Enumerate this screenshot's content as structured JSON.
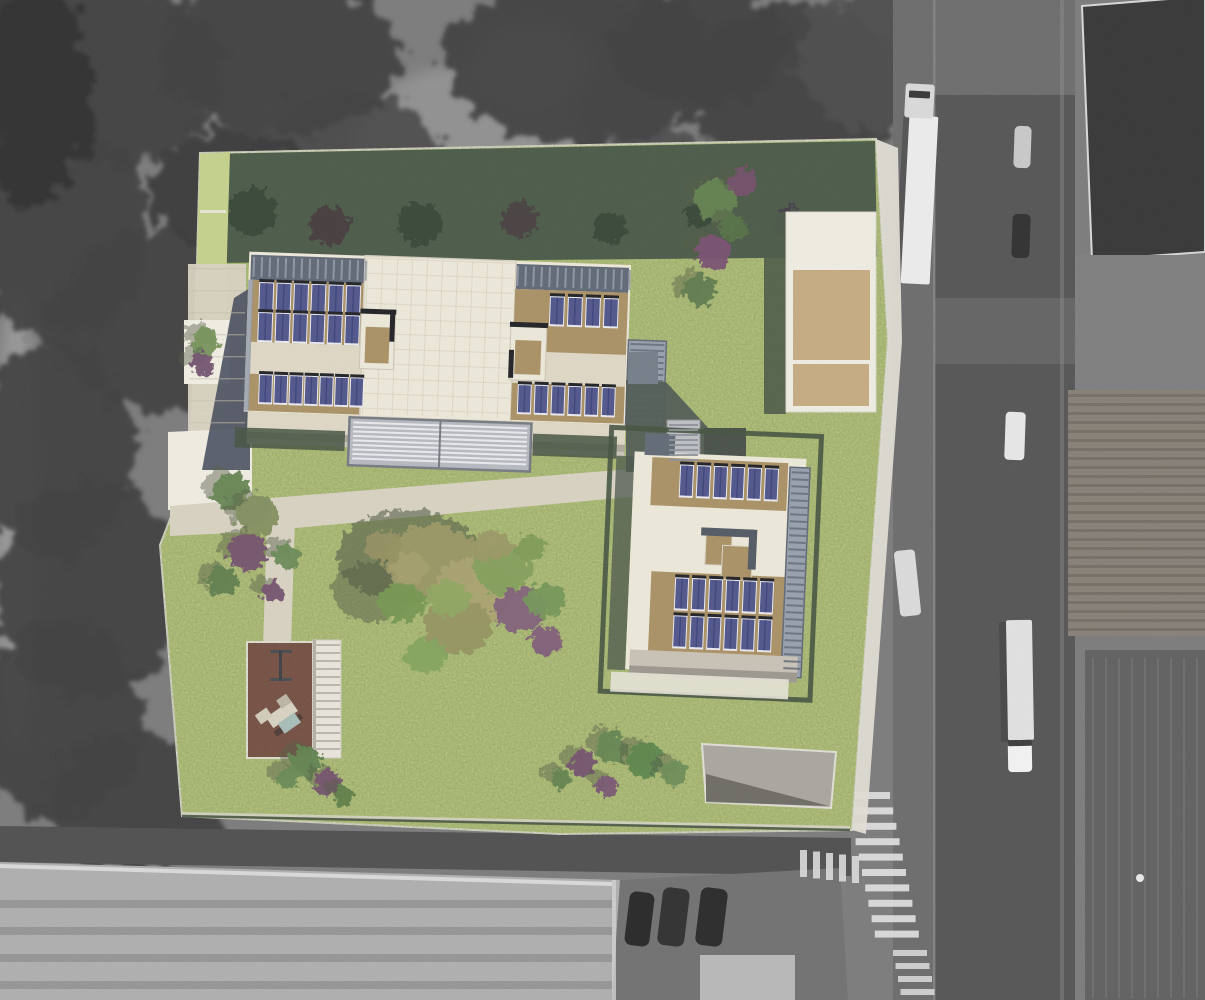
{
  "scene": {
    "kind": "aerial-photo-with-architectural-site-plan-overlay",
    "photo_style": "grayscale-orthophoto",
    "overlay_style": "colored-rendered-site-plan"
  },
  "palette": {
    "photoBg": "#757575",
    "forest": "#353535",
    "forestDark": "#282828",
    "road": "#4c4c4c",
    "sidewalk": "#646464",
    "roofLight": "#ababab",
    "buildDark": "#2d2d2d",
    "tileRoof": "#81796e",
    "warehouse": "#585858",
    "lawn": "#b8c878",
    "lawnLight": "#c2cf86",
    "lawnShadow": "#42523f",
    "cream": "#ece7d8",
    "cream2": "#ddd6c3",
    "tan": "#a78c5e",
    "tanLight": "#c3a87c",
    "panel": "#484d86",
    "panelDark": "#15161b",
    "panelEdge": "#e9e9f0",
    "skylight": "#59616f",
    "balcony": "#929ba8",
    "path": "#d7d0bf",
    "plaza": "#efece1",
    "maroon": "#6f4038",
    "hedge": "#3c4a37",
    "shadowBlue": "#3a4152",
    "courtyard": "#49534c",
    "pergola": "#b3b7bd"
  },
  "photo": {
    "forest": [
      {
        "x": 95,
        "y": 75,
        "rx": 130,
        "ry": 95
      },
      {
        "x": 280,
        "y": 55,
        "rx": 120,
        "ry": 80
      },
      {
        "x": 585,
        "y": 60,
        "rx": 140,
        "ry": 85
      },
      {
        "x": 800,
        "y": 90,
        "rx": 110,
        "ry": 85
      },
      {
        "x": 60,
        "y": 230,
        "rx": 90,
        "ry": 110
      },
      {
        "x": 160,
        "y": 320,
        "rx": 110,
        "ry": 90
      },
      {
        "x": 55,
        "y": 450,
        "rx": 80,
        "ry": 110
      },
      {
        "x": 90,
        "y": 590,
        "rx": 95,
        "ry": 110
      },
      {
        "x": 60,
        "y": 720,
        "rx": 85,
        "ry": 100
      },
      {
        "x": 135,
        "y": 800,
        "rx": 90,
        "ry": 70
      },
      {
        "x": 350,
        "y": 160,
        "rx": 90,
        "ry": 70,
        "o": 0.8
      },
      {
        "x": 700,
        "y": 45,
        "rx": 90,
        "ry": 60
      },
      {
        "x": 870,
        "y": 60,
        "rx": 70,
        "ry": 70,
        "c": "#424242"
      },
      {
        "x": 540,
        "y": 230,
        "rx": 80,
        "ry": 55,
        "o": 0.75
      },
      {
        "x": 660,
        "y": 180,
        "rx": 70,
        "ry": 50,
        "o": 0.7
      },
      {
        "x": 30,
        "y": 90,
        "rx": 60,
        "ry": 120,
        "c": "#262626"
      },
      {
        "x": 230,
        "y": 190,
        "rx": 80,
        "ry": 60,
        "c": "#2e2e2e"
      },
      {
        "x": 460,
        "y": 320,
        "rx": 60,
        "ry": 40,
        "o": 0.6
      }
    ],
    "clearings": [
      {
        "x": 470,
        "y": 150,
        "rx": 115,
        "ry": 85,
        "c": "#8e8e8e",
        "o": 0.9
      },
      {
        "x": 530,
        "y": 65,
        "rx": 60,
        "ry": 45,
        "c": "#9c9c9c",
        "o": 0.8
      },
      {
        "x": 250,
        "y": 330,
        "rx": 45,
        "ry": 35,
        "c": "#7e7e7e",
        "o": 0.6
      },
      {
        "x": 640,
        "y": 330,
        "rx": 55,
        "ry": 40,
        "c": "#757575",
        "o": 0.55
      },
      {
        "x": 16,
        "y": 520,
        "rx": 20,
        "ry": 230,
        "c": "#9a9a9a",
        "o": 0.8
      }
    ],
    "vehicles": [
      {
        "name": "semi-truck-shadow",
        "x": 899,
        "y": 116,
        "w": 8,
        "h": 168,
        "rx": 2,
        "c": "#2f2f2f",
        "o": 0.5,
        "rot": 3
      },
      {
        "name": "semi-truck-trailer",
        "x": 905,
        "y": 116,
        "w": 29,
        "h": 168,
        "rx": 2,
        "c": "#ececec",
        "rot": 3
      },
      {
        "name": "semi-truck-cab",
        "x": 905,
        "y": 84,
        "w": 29,
        "h": 34,
        "rx": 3,
        "c": "#d8d8d8",
        "rot": 3
      },
      {
        "name": "semi-truck-windshield",
        "x": 909,
        "y": 91,
        "w": 21,
        "h": 7,
        "rx": 1,
        "c": "#2c2c2c",
        "rot": 3
      },
      {
        "name": "car-light",
        "x": 1014,
        "y": 126,
        "w": 17,
        "h": 42,
        "rx": 5,
        "c": "#c6c6c6",
        "rot": 2
      },
      {
        "name": "car-dark",
        "x": 1012,
        "y": 214,
        "w": 18,
        "h": 44,
        "rx": 5,
        "c": "#262626",
        "rot": 2
      },
      {
        "name": "van-white",
        "x": 1005,
        "y": 412,
        "w": 20,
        "h": 48,
        "rx": 4,
        "c": "#e6e6e6",
        "rot": 2
      },
      {
        "name": "parked-truck-white",
        "x": 897,
        "y": 550,
        "w": 21,
        "h": 66,
        "rx": 4,
        "c": "#d9d9d9",
        "rot": -6
      },
      {
        "name": "box-truck-shadow",
        "x": 1000,
        "y": 622,
        "w": 8,
        "h": 120,
        "rx": 2,
        "c": "#2f2f2f",
        "o": 0.5,
        "rot": -1
      },
      {
        "name": "box-truck-body",
        "x": 1007,
        "y": 620,
        "w": 26,
        "h": 120,
        "rx": 2,
        "c": "#e0e0e0",
        "rot": -1
      },
      {
        "name": "box-truck-cab",
        "x": 1008,
        "y": 742,
        "w": 24,
        "h": 30,
        "rx": 4,
        "c": "#f2f2f2",
        "rot": -1
      },
      {
        "name": "box-truck-windshield",
        "x": 1008,
        "y": 740,
        "w": 24,
        "h": 6,
        "rx": 1,
        "c": "#333333",
        "rot": -1
      },
      {
        "name": "parked-car-1",
        "x": 627,
        "y": 892,
        "w": 25,
        "h": 54,
        "rx": 7,
        "c": "#1d1d1d",
        "rot": 7
      },
      {
        "name": "parked-car-2",
        "x": 660,
        "y": 888,
        "w": 27,
        "h": 58,
        "rx": 7,
        "c": "#262626",
        "rot": 7
      },
      {
        "name": "parked-car-3",
        "x": 698,
        "y": 888,
        "w": 27,
        "h": 58,
        "rx": 7,
        "c": "#1f1f1f",
        "rot": 7
      },
      {
        "name": "forest-car-white",
        "x": 202,
        "y": 428,
        "w": 12,
        "h": 9,
        "rx": 2,
        "c": "#e2e2e2",
        "o": 0.9,
        "rot": -20
      }
    ],
    "crosswalks": [
      {
        "name": "crosswalk-main",
        "x": 846,
        "y": 792,
        "w": 44,
        "h": 7,
        "count": 10,
        "dx": 3.2,
        "dy": 15.4,
        "c": "#dcdcdc",
        "o": 0.95
      },
      {
        "name": "crosswalk-south",
        "x": 893,
        "y": 950,
        "w": 34,
        "h": 6,
        "count": 4,
        "dx": 2.5,
        "dy": 13,
        "c": "#d6d6d6",
        "o": 0.9
      },
      {
        "name": "crosswalk-west",
        "x": 800,
        "y": 850,
        "w": 7,
        "h": 27,
        "count": 5,
        "dx": 13,
        "dy": 1.5,
        "c": "#dadada",
        "o": 0.9
      }
    ]
  },
  "plan": {
    "boundary": "200,153 876,139 888,340 852,830 560,834 182,816 160,545 190,468 196,300",
    "solar_rows": [
      {
        "building": "b1",
        "x": 258,
        "y": 289,
        "n": 6,
        "dx": 17.4,
        "w": 13,
        "h": 27
      },
      {
        "building": "b1",
        "x": 258,
        "y": 319,
        "n": 6,
        "dx": 17.4,
        "w": 13,
        "h": 27
      },
      {
        "building": "b1",
        "x": 261,
        "y": 381,
        "n": 7,
        "dx": 15.2,
        "w": 12,
        "h": 27
      },
      {
        "building": "b1",
        "x": 549,
        "y": 293,
        "n": 4,
        "dx": 18,
        "w": 13,
        "h": 27
      },
      {
        "building": "b1",
        "x": 520,
        "y": 382,
        "n": 6,
        "dx": 16.8,
        "w": 12,
        "h": 27
      },
      {
        "building": "b2",
        "x": 677,
        "y": 467,
        "n": 6,
        "dx": 17,
        "w": 12,
        "h": 30
      },
      {
        "building": "b2",
        "x": 677,
        "y": 580,
        "n": 6,
        "dx": 17,
        "w": 12,
        "h": 30
      },
      {
        "building": "b2",
        "x": 677,
        "y": 618,
        "n": 6,
        "dx": 17,
        "w": 12,
        "h": 30
      }
    ],
    "trees": [
      {
        "x": 206,
        "y": 341,
        "r": 14,
        "c": "#6f8d50"
      },
      {
        "x": 202,
        "y": 364,
        "r": 12,
        "c": "#6b4a68"
      },
      {
        "x": 716,
        "y": 200,
        "r": 21,
        "c": "#5d7c48"
      },
      {
        "x": 742,
        "y": 183,
        "r": 14,
        "c": "#6d4662"
      },
      {
        "x": 713,
        "y": 252,
        "r": 17,
        "c": "#74486a"
      },
      {
        "x": 699,
        "y": 291,
        "r": 16,
        "c": "#587546"
      },
      {
        "x": 734,
        "y": 228,
        "r": 13,
        "c": "#4e6a3e"
      },
      {
        "x": 231,
        "y": 492,
        "r": 19,
        "c": "#5f7f4a"
      },
      {
        "x": 257,
        "y": 516,
        "r": 21,
        "c": "#7c8a56"
      },
      {
        "x": 247,
        "y": 552,
        "r": 19,
        "c": "#6e4a66"
      },
      {
        "x": 222,
        "y": 582,
        "r": 15,
        "c": "#5a7a46"
      },
      {
        "x": 287,
        "y": 556,
        "r": 13,
        "c": "#64854e"
      },
      {
        "x": 272,
        "y": 592,
        "r": 11,
        "c": "#6d4a66"
      },
      {
        "x": 305,
        "y": 762,
        "r": 16,
        "c": "#5b7d48"
      },
      {
        "x": 328,
        "y": 783,
        "r": 13,
        "c": "#6e4a66"
      },
      {
        "x": 288,
        "y": 778,
        "r": 11,
        "c": "#61834c"
      },
      {
        "x": 344,
        "y": 796,
        "r": 10,
        "c": "#57793f"
      },
      {
        "x": 583,
        "y": 764,
        "r": 13,
        "c": "#6d4a66"
      },
      {
        "x": 612,
        "y": 748,
        "r": 16,
        "c": "#5e8048"
      },
      {
        "x": 645,
        "y": 760,
        "r": 18,
        "c": "#548044"
      },
      {
        "x": 674,
        "y": 772,
        "r": 13,
        "c": "#67884f"
      },
      {
        "x": 607,
        "y": 786,
        "r": 11,
        "c": "#744f6c"
      },
      {
        "x": 561,
        "y": 779,
        "r": 10,
        "c": "#5c7d46"
      }
    ],
    "band_trees": [
      {
        "x": 252,
        "y": 212,
        "r": 24,
        "c": "#2c3b2c"
      },
      {
        "x": 330,
        "y": 226,
        "r": 20,
        "c": "#3c3033"
      },
      {
        "x": 420,
        "y": 224,
        "r": 22,
        "c": "#2c3b2c"
      },
      {
        "x": 520,
        "y": 220,
        "r": 18,
        "c": "#403236"
      },
      {
        "x": 610,
        "y": 228,
        "r": 16,
        "c": "#2c3b2c"
      },
      {
        "x": 790,
        "y": 224,
        "r": 17,
        "c": "#383440"
      },
      {
        "x": 700,
        "y": 214,
        "r": 14,
        "c": "#2c3b2c"
      }
    ],
    "garden": [
      {
        "x": 408,
        "y": 556,
        "rx": 72,
        "ry": 46,
        "c": "#4a523c",
        "o": 0.6
      },
      {
        "x": 372,
        "y": 592,
        "rx": 40,
        "ry": 30,
        "c": "#4a523c",
        "o": 0.5
      },
      {
        "x": 432,
        "y": 562,
        "rx": 46,
        "ry": 38,
        "c": "#97945f"
      },
      {
        "x": 472,
        "y": 592,
        "rx": 40,
        "ry": 34,
        "c": "#a59e68"
      },
      {
        "x": 502,
        "y": 570,
        "rx": 28,
        "ry": 24,
        "c": "#7d9a52"
      },
      {
        "x": 457,
        "y": 626,
        "rx": 34,
        "ry": 28,
        "c": "#8f8e58"
      },
      {
        "x": 520,
        "y": 610,
        "rx": 26,
        "ry": 22,
        "c": "#7b5874"
      },
      {
        "x": 546,
        "y": 600,
        "rx": 20,
        "ry": 17,
        "c": "#6f9150"
      },
      {
        "x": 402,
        "y": 602,
        "rx": 24,
        "ry": 20,
        "c": "#709148"
      },
      {
        "x": 426,
        "y": 656,
        "rx": 21,
        "ry": 17,
        "c": "#7da054"
      },
      {
        "x": 384,
        "y": 546,
        "rx": 19,
        "ry": 16,
        "c": "#8f8c58"
      },
      {
        "x": 546,
        "y": 641,
        "rx": 16,
        "ry": 14,
        "c": "#7a5572"
      },
      {
        "x": 492,
        "y": 546,
        "rx": 21,
        "ry": 16,
        "c": "#96945e"
      },
      {
        "x": 530,
        "y": 548,
        "rx": 16,
        "ry": 13,
        "c": "#77964e"
      },
      {
        "x": 410,
        "y": 568,
        "rx": 18,
        "ry": 15,
        "c": "#a09a64"
      },
      {
        "x": 448,
        "y": 598,
        "rx": 22,
        "ry": 18,
        "c": "#8aa258"
      }
    ]
  },
  "stripes": [
    {
      "name": "skylight-ticks-left",
      "target": "b1-extras",
      "x": 250,
      "y": 263,
      "w": 112,
      "h": 20,
      "dir": "v",
      "gap": 8,
      "sw": 2,
      "c": "#8d96a4",
      "o": 0.9
    },
    {
      "name": "skylight-ticks-right",
      "target": "b1-extras",
      "x": 514,
      "y": 263,
      "w": 112,
      "h": 20,
      "dir": "v",
      "gap": 8,
      "sw": 2,
      "c": "#8d96a4",
      "o": 0.9
    },
    {
      "name": "balcony-stripes",
      "target": "b1-extras",
      "x": 630,
      "y": 336,
      "w": 34,
      "h": 78,
      "dir": "h",
      "gap": 6,
      "sw": 2,
      "c": "#5f6774",
      "o": 0.9
    },
    {
      "name": "pergola-slats",
      "target": "b1-extras",
      "x": 356,
      "y": 424,
      "w": 174,
      "h": 38,
      "dir": "h",
      "gap": 4.5,
      "sw": 2,
      "c": "#eef0f2",
      "o": 0.9
    },
    {
      "name": "roof-grid-v",
      "target": "b1-extras",
      "x": 364,
      "y": 260,
      "w": 147,
      "h": 156,
      "dir": "v",
      "gap": 15,
      "sw": 1,
      "c": "#d9d2c0",
      "o": 0.8
    },
    {
      "name": "roof-grid-h",
      "target": "b1-extras",
      "x": 364,
      "y": 260,
      "w": 147,
      "h": 156,
      "dir": "h",
      "gap": 15,
      "sw": 1,
      "c": "#d9d2c0",
      "o": 0.8
    },
    {
      "name": "plaza-grid",
      "target": "plan-extras",
      "x": 189,
      "y": 268,
      "w": 56,
      "h": 158,
      "dir": "h",
      "gap": 22,
      "sw": 1.4,
      "c": "#c2bbaa",
      "o": 0.5
    },
    {
      "name": "stair-rungs",
      "target": "plan-extras",
      "x": 314,
      "y": 644,
      "w": 26,
      "h": 110,
      "dir": "h",
      "gap": 8,
      "sw": 2,
      "c": "#b7b3a7",
      "o": 1
    },
    {
      "name": "bridge-stripes",
      "target": "plan-extras",
      "x": 669,
      "y": 424,
      "w": 29,
      "h": 38,
      "dir": "h",
      "gap": 5,
      "sw": 2,
      "c": "#878c92",
      "o": 0.9
    },
    {
      "name": "b2-balcony-stripes",
      "target": "b2-extras",
      "x": 788,
      "y": 468,
      "w": 17,
      "h": 202,
      "dir": "h",
      "gap": 7,
      "sw": 2,
      "c": "#5f6774",
      "o": 0.9
    },
    {
      "name": "tiled-roof-lines",
      "target": "photo-extras",
      "x": 1068,
      "y": 394,
      "w": 137,
      "h": 240,
      "dir": "h",
      "gap": 9,
      "sw": 3,
      "c": "#6b645c",
      "o": 0.8
    },
    {
      "name": "warehouse-streaks",
      "target": "photo-extras",
      "x": 1092,
      "y": 658,
      "w": 110,
      "h": 340,
      "dir": "v",
      "gap": 13,
      "sw": 2,
      "c": "#6f6f6f",
      "o": 0.6
    },
    {
      "name": "factory-roof-bands",
      "target": "photo-extras",
      "x": 0,
      "y": 900,
      "w": 612,
      "h": 84,
      "dir": "h",
      "gap": 27,
      "sw": 8,
      "c": "#8b8b8b",
      "o": 0.8
    }
  ]
}
